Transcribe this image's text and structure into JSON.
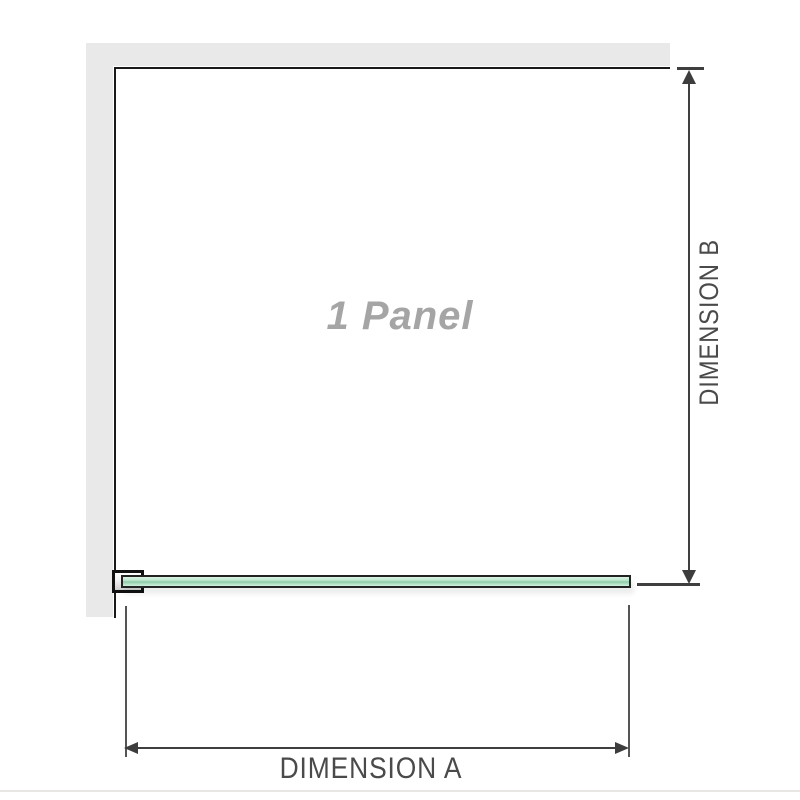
{
  "diagram": {
    "title": "1 Panel shower screen plan diagram",
    "panel_label": "1 Panel",
    "dimension_a": {
      "label": "DIMENSION A",
      "orientation": "horizontal",
      "position": "bottom"
    },
    "dimension_b": {
      "label": "DIMENSION B",
      "orientation": "vertical",
      "position": "right"
    },
    "elements": {
      "walls": "L-shaped wall strips along top and left",
      "glass": "single glass panel bar along bottom, held by wall bracket at left"
    }
  },
  "colors": {
    "background": "#ffffff",
    "wall_gray": "#e9e9e9",
    "panel_outline": "#1a1a1a",
    "glass_border": "#222222",
    "glass_green_light": "#d9f2e2",
    "glass_green_mid": "#8fcaa8",
    "dimension_line": "#3f3f3f",
    "dimension_text": "#4a4a4a",
    "panel_text_gray": "#a5a5a5",
    "bottom_rule": "#e9e7e4"
  }
}
